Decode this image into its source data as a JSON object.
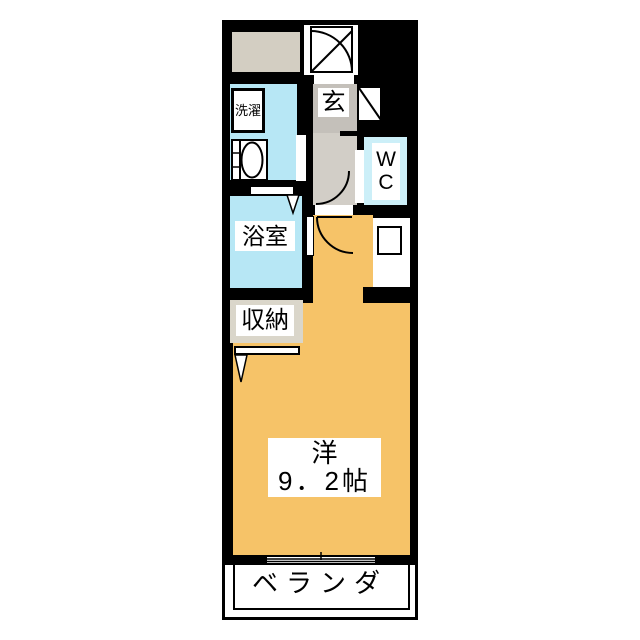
{
  "floorplan": {
    "entrance": {
      "label": "玄"
    },
    "laundry": {
      "label": "洗濯"
    },
    "wc": {
      "line1": "W",
      "line2": "C"
    },
    "bathroom": {
      "label": "浴室"
    },
    "closet": {
      "label": "収納"
    },
    "main_room": {
      "type_label": "洋",
      "size_label": "9．2帖"
    },
    "veranda": {
      "label": "ベランダ"
    },
    "colors": {
      "wall": "#000000",
      "main_room": "#f6c368",
      "wet_area": "#b7e7f5",
      "wc": "#cceff8",
      "entrance_floor": "#c4c0ba",
      "hallway_floor": "#d2cec7",
      "service_space": "#d3cec2",
      "closet": "#dad6ca"
    }
  }
}
